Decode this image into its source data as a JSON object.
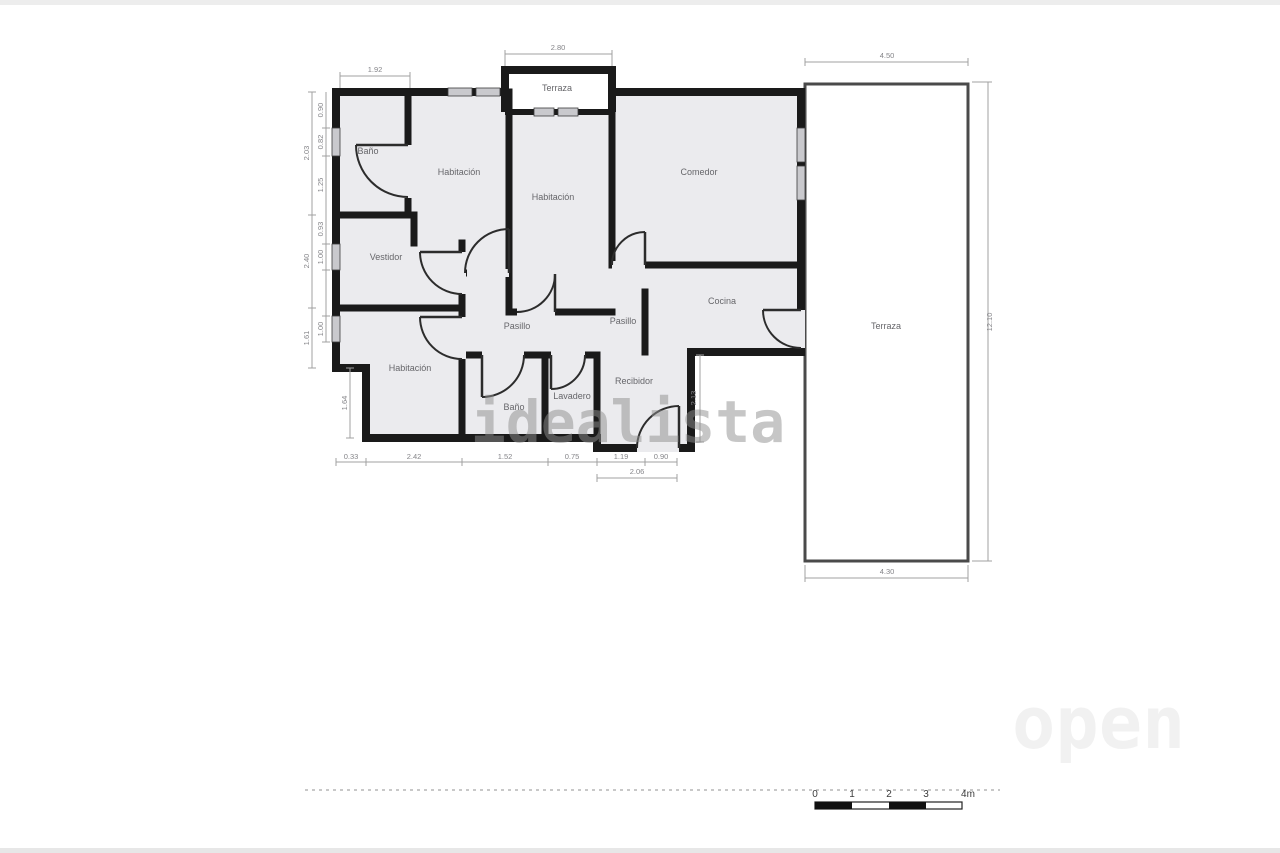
{
  "plan": {
    "watermark_center": "idealista",
    "watermark_corner": "open",
    "rooms": [
      {
        "id": "bano-1",
        "label": "Baño"
      },
      {
        "id": "habitacion-1",
        "label": "Habitación"
      },
      {
        "id": "terraza-top",
        "label": "Terraza"
      },
      {
        "id": "habitacion-2",
        "label": "Habitación"
      },
      {
        "id": "comedor",
        "label": "Comedor"
      },
      {
        "id": "vestidor",
        "label": "Vestidor"
      },
      {
        "id": "pasillo-1",
        "label": "Pasillo"
      },
      {
        "id": "pasillo-2",
        "label": "Pasillo"
      },
      {
        "id": "cocina",
        "label": "Cocina"
      },
      {
        "id": "habitacion-3",
        "label": "Habitación"
      },
      {
        "id": "bano-2",
        "label": "Baño"
      },
      {
        "id": "lavadero",
        "label": "Lavadero"
      },
      {
        "id": "recibidor",
        "label": "Recibidor"
      },
      {
        "id": "terraza-right",
        "label": "Terraza"
      }
    ],
    "dims": {
      "top_left": "1.92",
      "top_terrace": "2.80",
      "terrace_top": "4.50",
      "terrace_right": "12.10",
      "terrace_bottom": "4.30",
      "left_outer": [
        "2.03",
        "2.40",
        "1.61"
      ],
      "left_inner": [
        "0.90",
        "0.82",
        "1.25",
        "0.93",
        "1.00",
        "1.00"
      ],
      "left_step": "1.64",
      "bottom": [
        "0.33",
        "2.42",
        "1.52",
        "0.75",
        "1.19",
        "0.90"
      ],
      "bottom_recibidor": "2.06",
      "recibidor_side": "2.13"
    },
    "scale_bar": {
      "labels": [
        "0",
        "1",
        "2",
        "3",
        "4m"
      ]
    },
    "colors": {
      "wall": "#1a1a1a",
      "floor": "#ebebee",
      "terrace_floor": "#ffffff",
      "window": "#c9c9cd",
      "dim": "#a0a0a0",
      "door": "#2c2c2c"
    }
  }
}
